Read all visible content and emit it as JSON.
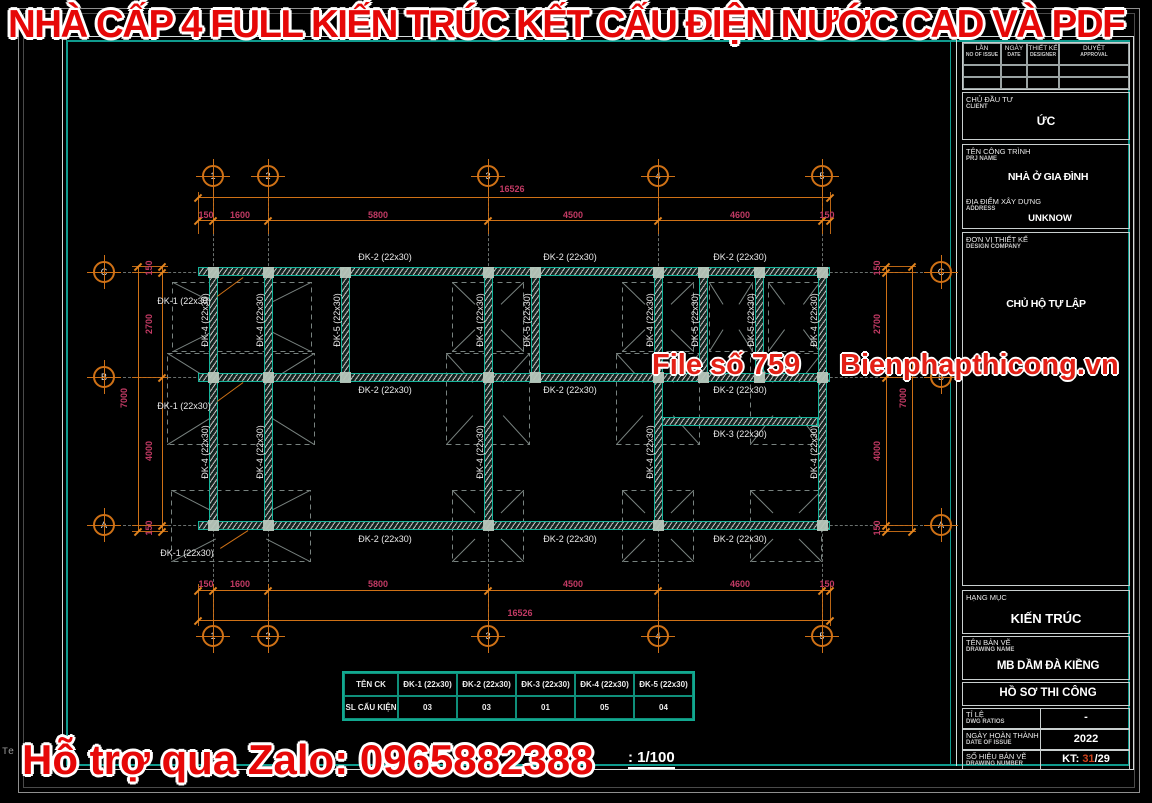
{
  "banner_top": "NHÀ CẤP 4 FULL KIẾN TRÚC KẾT CẤU ĐIỆN NƯỚC CAD VÀ PDF",
  "banner_bottom": "Hỗ trợ qua Zalo: 0965882388",
  "watermark_left": "File số 759",
  "watermark_right": "Bienphapthicong.vn",
  "scale_note": ": 1/100",
  "corner_fragment": "Te",
  "colors": {
    "dim_line": "#cf7116",
    "dim_text": "#c23a64",
    "beam_teal": "#16b39a",
    "banner_red": "#e60808",
    "grid_gray": "#7d8482"
  },
  "schedule_table": {
    "headers": [
      "TÊN CK",
      "ĐK-1 (22x30)",
      "ĐK-2 (22x30)",
      "ĐK-3 (22x30)",
      "ĐK-4 (22x30)",
      "ĐK-5 (22x30)"
    ],
    "row": [
      "SL CẤU KIỆN",
      "03",
      "03",
      "01",
      "05",
      "04"
    ]
  },
  "titleblock": {
    "revision_cols": [
      {
        "vi": "LẦN",
        "en": "NO OF ISSUE"
      },
      {
        "vi": "NGÀY",
        "en": "DATE"
      },
      {
        "vi": "THIẾT KẾ",
        "en": "DESIGNER"
      },
      {
        "vi": "DUYỆT",
        "en": "APPROVAL"
      }
    ],
    "client_label": "CHỦ ĐẦU TƯ",
    "client_sub": "CLIENT",
    "client_value": "ỨC",
    "project_label": "TÊN CÔNG TRÌNH",
    "project_sub": "PRJ NAME",
    "project_value": "NHÀ Ở GIA ĐÌNH",
    "address_label": "ĐỊA ĐIỂM XÂY DỰNG",
    "address_sub": "ADDRESS",
    "address_value": "UNKNOW",
    "designer_label": "ĐƠN VỊ THIẾT KẾ",
    "designer_sub": "DESIGN COMPANY",
    "designer_value": "CHỦ HỘ TỰ LẬP",
    "category_label": "HẠNG MỤC",
    "category_value": "KIẾN TRÚC",
    "drawing_label": "TÊN BẢN VẼ",
    "drawing_sub": "DRAWING NAME",
    "drawing_value": "MB DẦM ĐÀ KIỀNG",
    "phase_value": "HỒ SƠ THI CÔNG",
    "ratio_label": "TỈ LỆ",
    "ratio_sub": "DWG RATIOS",
    "ratio_value": "-",
    "date_label": "NGÀY HOÀN THÀNH",
    "date_sub": "DATE OF ISSUE",
    "date_value": "2022",
    "number_label": "SỐ HIỆU BẢN VẼ",
    "number_sub": "DRAWING NUMBER",
    "number_prefix": "KT: ",
    "number_hl": "31",
    "number_suffix": "/29"
  },
  "plan": {
    "grid_cols": [
      {
        "id": "1",
        "x": 213
      },
      {
        "id": "2",
        "x": 268
      },
      {
        "id": "3",
        "x": 488
      },
      {
        "id": "4",
        "x": 658
      },
      {
        "id": "5",
        "x": 822
      }
    ],
    "grid_rows": [
      {
        "id": "C",
        "y": 272
      },
      {
        "id": "B",
        "y": 377
      },
      {
        "id": "A",
        "y": 525
      }
    ],
    "bubble_y_top": 176,
    "bubble_y_bottom": 636,
    "bubble_x_left": 104,
    "bubble_x_right": 941,
    "dims": {
      "top_segments": [
        {
          "t": "150",
          "x": 206,
          "y": 215
        },
        {
          "t": "1600",
          "x": 240,
          "y": 215
        },
        {
          "t": "5800",
          "x": 378,
          "y": 215
        },
        {
          "t": "4500",
          "x": 573,
          "y": 215
        },
        {
          "t": "4600",
          "x": 740,
          "y": 215
        },
        {
          "t": "150",
          "x": 827,
          "y": 215
        }
      ],
      "top_total": {
        "t": "16526",
        "x": 512,
        "y": 189
      },
      "bottom_segments": [
        {
          "t": "150",
          "x": 206,
          "y": 584
        },
        {
          "t": "1600",
          "x": 240,
          "y": 584
        },
        {
          "t": "5800",
          "x": 378,
          "y": 584
        },
        {
          "t": "4500",
          "x": 573,
          "y": 584
        },
        {
          "t": "4600",
          "x": 740,
          "y": 584
        },
        {
          "t": "150",
          "x": 827,
          "y": 584
        }
      ],
      "bottom_total": {
        "t": "16526",
        "x": 520,
        "y": 613
      },
      "left_segments": [
        {
          "t": "150",
          "x": 149,
          "y": 268
        },
        {
          "t": "2700",
          "x": 149,
          "y": 324
        },
        {
          "t": "4000",
          "x": 149,
          "y": 451
        },
        {
          "t": "150",
          "x": 149,
          "y": 528
        }
      ],
      "left_total": {
        "t": "7000",
        "x": 124,
        "y": 398
      },
      "right_segments": [
        {
          "t": "150",
          "x": 877,
          "y": 268
        },
        {
          "t": "2700",
          "x": 877,
          "y": 324
        },
        {
          "t": "4000",
          "x": 877,
          "y": 451
        },
        {
          "t": "150",
          "x": 877,
          "y": 528
        }
      ],
      "right_total": {
        "t": "7000",
        "x": 903,
        "y": 398
      }
    },
    "beams_h": [
      {
        "x1": 198,
        "x2": 830,
        "y": 271
      },
      {
        "x1": 198,
        "x2": 830,
        "y": 377
      },
      {
        "x1": 198,
        "x2": 830,
        "y": 525
      },
      {
        "x1": 662,
        "x2": 818,
        "y": 421
      }
    ],
    "beams_v": [
      {
        "x": 213,
        "y1": 267,
        "y2": 530
      },
      {
        "x": 268,
        "y1": 267,
        "y2": 530
      },
      {
        "x": 488,
        "y1": 267,
        "y2": 530
      },
      {
        "x": 658,
        "y1": 267,
        "y2": 530
      },
      {
        "x": 822,
        "y1": 267,
        "y2": 530
      },
      {
        "x": 345,
        "y1": 267,
        "y2": 381
      },
      {
        "x": 535,
        "y1": 267,
        "y2": 381
      },
      {
        "x": 703,
        "y1": 267,
        "y2": 381
      },
      {
        "x": 759,
        "y1": 267,
        "y2": 381
      }
    ],
    "h_labels": [
      {
        "t": "ĐK-2 (22x30)",
        "x": 385,
        "y": 257
      },
      {
        "t": "ĐK-2 (22x30)",
        "x": 570,
        "y": 257
      },
      {
        "t": "ĐK-2 (22x30)",
        "x": 740,
        "y": 257
      },
      {
        "t": "ĐK-2 (22x30)",
        "x": 385,
        "y": 390
      },
      {
        "t": "ĐK-2 (22x30)",
        "x": 570,
        "y": 390
      },
      {
        "t": "ĐK-2 (22x30)",
        "x": 740,
        "y": 390
      },
      {
        "t": "ĐK-2 (22x30)",
        "x": 385,
        "y": 539
      },
      {
        "t": "ĐK-2 (22x30)",
        "x": 570,
        "y": 539
      },
      {
        "t": "ĐK-2 (22x30)",
        "x": 740,
        "y": 539
      },
      {
        "t": "ĐK-3 (22x30)",
        "x": 740,
        "y": 434
      }
    ],
    "v_labels": [
      {
        "t": "ĐK-4 (22x30)",
        "x": 205,
        "y": 320
      },
      {
        "t": "ĐK-4 (22x30)",
        "x": 260,
        "y": 320
      },
      {
        "t": "ĐK-5 (22x30)",
        "x": 337,
        "y": 320
      },
      {
        "t": "ĐK-4 (22x30)",
        "x": 480,
        "y": 320
      },
      {
        "t": "ĐK-5 (22x30)",
        "x": 527,
        "y": 320
      },
      {
        "t": "ĐK-4 (22x30)",
        "x": 650,
        "y": 320
      },
      {
        "t": "ĐK-5 (22x30)",
        "x": 695,
        "y": 320
      },
      {
        "t": "ĐK-5 (22x30)",
        "x": 751,
        "y": 320
      },
      {
        "t": "ĐK-4 (22x30)",
        "x": 814,
        "y": 320
      },
      {
        "t": "ĐK-4 (22x30)",
        "x": 205,
        "y": 452
      },
      {
        "t": "ĐK-4 (22x30)",
        "x": 260,
        "y": 452
      },
      {
        "t": "ĐK-4 (22x30)",
        "x": 480,
        "y": 452
      },
      {
        "t": "ĐK-4 (22x30)",
        "x": 650,
        "y": 452
      },
      {
        "t": "ĐK-4 (22x30)",
        "x": 814,
        "y": 452
      }
    ],
    "dk1_labels": [
      {
        "t": "ĐK-1 (22x30)",
        "x": 184,
        "y": 301
      },
      {
        "t": "ĐK-1 (22x30)",
        "x": 184,
        "y": 406
      },
      {
        "t": "ĐK-1 (22x30)",
        "x": 187,
        "y": 553
      }
    ],
    "leaders": [
      [
        217,
        296,
        243,
        277
      ],
      [
        217,
        401,
        243,
        382
      ],
      [
        220,
        548,
        248,
        530
      ]
    ],
    "column_points": [
      [
        213,
        272
      ],
      [
        268,
        272
      ],
      [
        488,
        272
      ],
      [
        658,
        272
      ],
      [
        822,
        272
      ],
      [
        345,
        272
      ],
      [
        535,
        272
      ],
      [
        703,
        272
      ],
      [
        759,
        272
      ],
      [
        213,
        377
      ],
      [
        268,
        377
      ],
      [
        488,
        377
      ],
      [
        658,
        377
      ],
      [
        822,
        377
      ],
      [
        345,
        377
      ],
      [
        535,
        377
      ],
      [
        703,
        377
      ],
      [
        759,
        377
      ],
      [
        213,
        525
      ],
      [
        268,
        525
      ],
      [
        488,
        525
      ],
      [
        658,
        525
      ],
      [
        822,
        525
      ]
    ],
    "footings": [
      [
        242,
        317,
        140,
        70
      ],
      [
        488,
        317,
        72,
        70
      ],
      [
        658,
        317,
        72,
        70
      ],
      [
        731,
        317,
        44,
        70
      ],
      [
        794,
        317,
        52,
        70
      ],
      [
        241,
        399,
        148,
        92
      ],
      [
        488,
        399,
        84,
        92
      ],
      [
        658,
        399,
        84,
        92
      ],
      [
        786,
        399,
        72,
        92
      ],
      [
        241,
        526,
        140,
        72
      ],
      [
        488,
        526,
        72,
        72
      ],
      [
        658,
        526,
        72,
        72
      ],
      [
        786,
        526,
        72,
        72
      ]
    ]
  }
}
